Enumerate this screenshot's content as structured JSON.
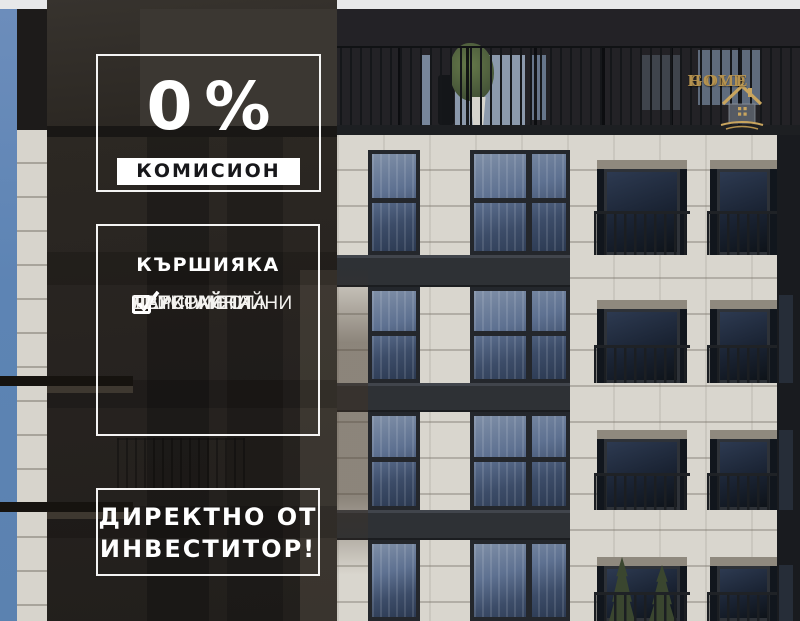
{
  "meta": {
    "width_px": 800,
    "height_px": 621
  },
  "overlay": {
    "promo": {
      "percent": "0%",
      "banner": "КОМИСИОН"
    },
    "listing": {
      "title": "КЪРШИЯКА",
      "items": [
        {
          "label": "ДВУСТАЙНИ",
          "checked": true
        },
        {
          "label": "ТРИСТАЙНИ",
          "checked": true
        },
        {
          "label": "ЧЕТИРИСТАЙНИ",
          "checked": true
        },
        {
          "label": "ПАРКОМЕСТА",
          "checked": true
        }
      ]
    },
    "cta": {
      "line1": "ДИРЕКТНО ОТ",
      "line2": "ИНВЕСТИТОР!"
    }
  },
  "logo": {
    "word_left": "GOLD",
    "word_right": "HOME"
  },
  "icons": {
    "checkbox_checked": "white square outline with check mark ✓",
    "logo_house": "gold house with chimney and swoosh underline"
  },
  "colors": {
    "gold_accent": "#b5924f",
    "sky_blue": "#5d84b4",
    "stone_light": "#d9d6ce",
    "facade_dark": "#232226",
    "overlay_dark": "#2c2823",
    "banner_bg": "#ffffff",
    "banner_text": "#17171a",
    "overlay_text": "#ffffff",
    "glass_blue": "#5e7191",
    "conifer_green": "#3a462f"
  }
}
